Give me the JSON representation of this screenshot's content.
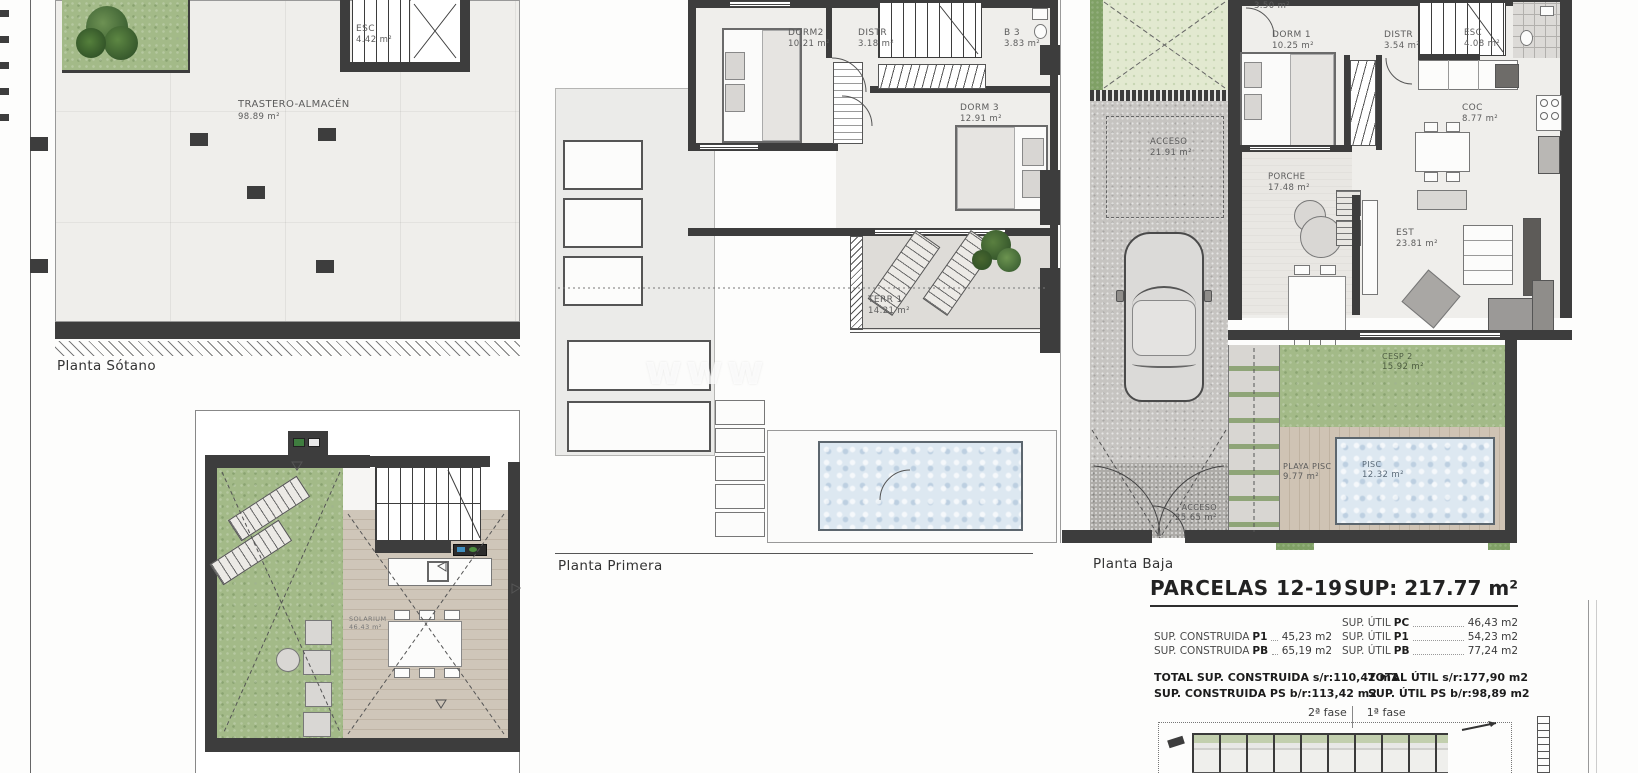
{
  "frame": {
    "watermark": "www"
  },
  "plans": {
    "sotano": {
      "label": "Planta Sótano",
      "rooms": {
        "esc": {
          "name": "ESC",
          "area": "4.42 m²"
        },
        "trastero": {
          "name": "TRASTERO-ALMACÉN",
          "area": "98.89 m²"
        }
      }
    },
    "primera": {
      "label": "Planta Primera",
      "rooms": {
        "dorm2": {
          "name": "DORM2",
          "area": "10.21 m²"
        },
        "distr": {
          "name": "DISTR",
          "area": "3.18 m²"
        },
        "b3": {
          "name": "B 3",
          "area": "3.83 m²"
        },
        "dorm3": {
          "name": "DORM 3",
          "area": "12.91 m²"
        },
        "terr1": {
          "name": "TERR 1",
          "area": "14.21 m²"
        }
      }
    },
    "baja": {
      "label": "Planta Baja",
      "rooms": {
        "b2": {
          "name": "",
          "area": "3.50 m²"
        },
        "dorm1": {
          "name": "DORM 1",
          "area": "10.25 m²"
        },
        "distr": {
          "name": "DISTR",
          "area": "3.54 m²"
        },
        "esc": {
          "name": "ESC",
          "area": "4.08 m²"
        },
        "coc": {
          "name": "COC",
          "area": "8.77 m²"
        },
        "acceso": {
          "name": "ACCESO",
          "area": "21.91 m²"
        },
        "porche": {
          "name": "PORCHE",
          "area": "17.48 m²"
        },
        "est": {
          "name": "EST",
          "area": "23.81 m²"
        },
        "cesp2": {
          "name": "CESP 2",
          "area": "15.92 m²"
        },
        "playa_pisc": {
          "name": "PLAYA PISC",
          "area": "9.77 m²"
        },
        "pisc": {
          "name": "PISC",
          "area": "12.32 m²"
        },
        "acceso2": {
          "name": "ACCESO",
          "area": "25.65 m²"
        }
      }
    },
    "cubierta": {
      "rooms": {
        "solarium": {
          "name": "SOLARIUM",
          "area": "46.43 m²"
        }
      }
    }
  },
  "summary": {
    "title": "PARCELAS 12-19",
    "sup_total": "SUP: 217.77 m²",
    "rows_left": [
      {
        "label": "SUP. CONSTRUIDA",
        "key": "P1",
        "value": "45,23 m2"
      },
      {
        "label": "SUP. CONSTRUIDA",
        "key": "PB",
        "value": "65,19 m2"
      }
    ],
    "rows_right": [
      {
        "label": "SUP. ÚTIL",
        "key": "PC",
        "value": "46,43 m2"
      },
      {
        "label": "SUP. ÚTIL",
        "key": "P1",
        "value": "54,23 m2"
      },
      {
        "label": "SUP. ÚTIL",
        "key": "PB",
        "value": "77,24 m2"
      }
    ],
    "totals_left": [
      {
        "label": "TOTAL SUP. CONSTRUIDA",
        "suffix": "s/r:",
        "value": "110,42 m2"
      },
      {
        "label": "SUP. CONSTRUIDA PS",
        "suffix": "b/r:",
        "value": "113,42 m2"
      }
    ],
    "totals_right": [
      {
        "label": "TOTAL ÚTIL",
        "suffix": "s/r:",
        "value": "177,90 m2"
      },
      {
        "label": "SUP. ÚTIL PS",
        "suffix": "b/r:",
        "value": "98,89 m2"
      }
    ],
    "phases": {
      "second": "2ª fase",
      "first": "1ª fase"
    }
  }
}
